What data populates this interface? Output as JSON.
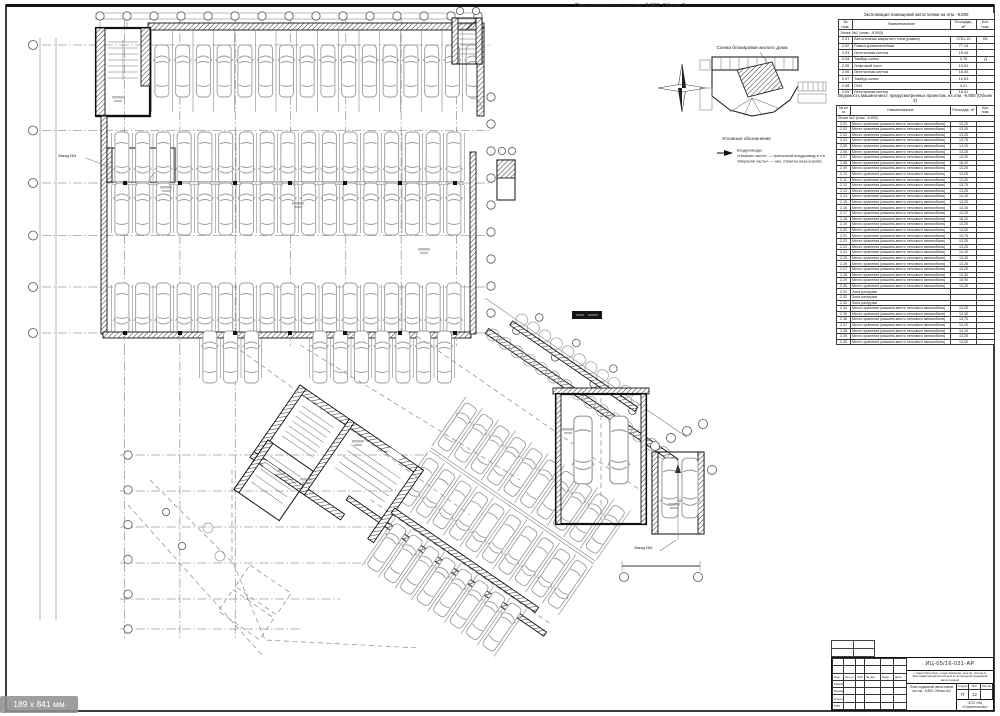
{
  "page": {
    "doc_title": "План автостоянки на отм. -9.800. Объем 2",
    "size_badge": "189 x 841 мм"
  },
  "key_plan": {
    "title": "Схема блокировки жилого дома"
  },
  "legend": {
    "title": "Условные обозначения",
    "heading": "Воздуховоды:",
    "line1": "«Нижняя часть» — приточный воздуховод в т/п",
    "line2": "«Верхняя часть» — низ. отметка низа короба"
  },
  "plan_labels": {
    "entry1": "Заезд №1",
    "entry2": "Заезд №2"
  },
  "tables": {
    "rooms": {
      "title": "Экспликация помещений автостоянки на отм. -9.800",
      "rows": [
        [
          "№ пом.",
          "Наименование",
          "Площадь, м²",
          "Кат. пом."
        ],
        [
          "@group",
          "Этаж №2 (отм. -9.800)"
        ],
        [
          "2.01",
          "Автостоянка закрытого типа (рампа)",
          "2761,10",
          "В1"
        ],
        [
          "2.02",
          "Рампа криволинейная",
          "77,14",
          ""
        ],
        [
          "2.03",
          "Лестничная клетка",
          "15,48",
          ""
        ],
        [
          "2.04",
          "Тамбур-шлюз",
          "4,76",
          "Д"
        ],
        [
          "2.05",
          "Лифтовой холл",
          "10,81",
          ""
        ],
        [
          "2.06",
          "Лестничная клетка",
          "16,45",
          ""
        ],
        [
          "2.07",
          "Тамбур-шлюз",
          "10,53",
          ""
        ],
        [
          "2.08",
          "ПУИ",
          "4,21",
          ""
        ],
        [
          "2.09",
          "Лестничная клетка",
          "16,31",
          ""
        ],
        [
          "2.10",
          "Тамбур-шлюз",
          "6,34",
          ""
        ],
        [
          "2.11",
          "Лифтовой холл",
          "8,09",
          ""
        ]
      ]
    },
    "parking": {
      "title": "Ведомость машино-мест, предусмотренных проектом, на отм. -9.800 (Объем 2)",
      "rows": [
        [
          "№ м/м",
          "Наименование",
          "Площадь, м²",
          "Кат. пом."
        ],
        [
          "@group",
          "Этаж №2 (отм. -9.800)"
        ],
        [
          "2.01",
          "Место хранения (машино-место легкового автомобиля)",
          "13,25",
          ""
        ],
        [
          "2.02",
          "Место хранения (машино-место легкового автомобиля)",
          "13,30",
          ""
        ],
        [
          "2.03",
          "Место хранения (машино-место легкового автомобиля)",
          "13,25",
          ""
        ],
        [
          "2.04",
          "Место хранения (машино-место легкового автомобиля)",
          "13,75",
          ""
        ],
        [
          "2.05",
          "Место хранения (машино-место легкового автомобиля)",
          "14,10",
          ""
        ],
        [
          "2.06",
          "Место хранения (машино-место легкового автомобиля)",
          "13,25",
          ""
        ],
        [
          "2.07",
          "Место хранения (машино-место легкового автомобиля)",
          "13,30",
          ""
        ],
        [
          "2.08",
          "Место хранения (машино-место легкового автомобиля)",
          "16,00",
          ""
        ],
        [
          "2.09",
          "Место хранения (машино-место легкового автомобиля)",
          "13,25",
          ""
        ],
        [
          "2.10",
          "Место хранения (машино-место легкового автомобиля)",
          "13,25",
          ""
        ],
        [
          "2.11",
          "Место хранения (машино-место легкового автомобиля)",
          "13,30",
          ""
        ],
        [
          "2.12",
          "Место хранения (машино-место легкового автомобиля)",
          "13,75",
          ""
        ],
        [
          "2.13",
          "Место хранения (машино-место легкового автомобиля)",
          "13,25",
          ""
        ],
        [
          "2.14",
          "Место хранения (машино-место легкового автомобиля)",
          "14,10",
          ""
        ],
        [
          "2.15",
          "Место хранения (машино-место легкового автомобиля)",
          "13,25",
          ""
        ],
        [
          "2.16",
          "Место хранения (машино-место легкового автомобиля)",
          "13,30",
          ""
        ],
        [
          "2.17",
          "Место хранения (машино-место легкового автомобиля)",
          "13,25",
          ""
        ],
        [
          "2.18",
          "Место хранения (машино-место легкового автомобиля)",
          "18,20",
          ""
        ],
        [
          "2.19",
          "Место хранения (машино-место легкового автомобиля)",
          "13,25",
          ""
        ],
        [
          "2.20",
          "Место хранения (машино-место легкового автомобиля)",
          "13,30",
          ""
        ],
        [
          "2.21",
          "Место хранения (машино-место легкового автомобиля)",
          "13,75",
          ""
        ],
        [
          "2.22",
          "Место хранения (машино-место легкового автомобиля)",
          "13,25",
          ""
        ],
        [
          "2.23",
          "Место хранения (машино-место легкового автомобиля)",
          "13,25",
          ""
        ],
        [
          "2.24",
          "Место хранения (машино-место легкового автомобиля)",
          "14,10",
          ""
        ],
        [
          "2.25",
          "Место хранения (машино-место легкового автомобиля)",
          "13,30",
          ""
        ],
        [
          "2.26",
          "Место хранения (машино-место легкового автомобиля)",
          "13,25",
          ""
        ],
        [
          "2.27",
          "Место хранения (машино-место легкового автомобиля)",
          "13,25",
          ""
        ],
        [
          "2.28",
          "Место хранения (машино-место легкового автомобиля)",
          "13,30",
          ""
        ],
        [
          "2.29",
          "Место хранения (машино-место легкового автомобиля)",
          "15,90",
          ""
        ],
        [
          "2.30",
          "Место хранения (машино-место легкового автомобиля)",
          "13,25",
          ""
        ],
        [
          "2.31",
          "Зона разгрузки",
          "",
          ""
        ],
        [
          "2.32",
          "Зона разгрузки",
          "",
          ""
        ],
        [
          "2.33",
          "Зона разгрузки",
          "",
          ""
        ],
        [
          "2.34",
          "Место хранения (машино-место легкового автомобиля)",
          "13,25",
          ""
        ],
        [
          "2.35",
          "Место хранения (машино-место легкового автомобиля)",
          "13,30",
          ""
        ],
        [
          "2.36",
          "Место хранения (машино-место легкового автомобиля)",
          "13,75",
          ""
        ],
        [
          "2.37",
          "Место хранения (машино-место легкового автомобиля)",
          "13,25",
          ""
        ],
        [
          "2.38",
          "Место хранения (машино-место легкового автомобиля)",
          "14,10",
          ""
        ],
        [
          "2.39",
          "Место хранения (машино-место легкового автомобиля)",
          "13,25",
          ""
        ],
        [
          "2.40",
          "Место хранения (машино-место легкового автомобиля)",
          "13,30",
          ""
        ]
      ]
    }
  },
  "stamp": {
    "code": "ИЦ-05/16-031-АР",
    "object_line": "г. Санкт-Петербург, улица Типанова, дом 21, литера А. Многоквартирный жилой дом со встроенной подземной автостоянкой",
    "sheet_title": "План подземной автостоянки на отм. -9.800. Объем №2",
    "stage_label": "Стадия",
    "sheet_label": "Лист",
    "sheets_label": "Листов",
    "stage": "П",
    "sheet_no": "12",
    "sheets_total": "",
    "org": "ООО «НЦ «Строительство»",
    "left_rows": [
      [
        "",
        "",
        "",
        "",
        "",
        ""
      ],
      [
        "",
        "",
        "",
        "",
        "",
        ""
      ],
      [
        "Изм.",
        "Кол.уч.",
        "Лист",
        "№ док.",
        "Подп.",
        "Дата"
      ],
      [
        "Разраб.",
        "",
        "",
        "",
        "",
        ""
      ],
      [
        "Проверил",
        "",
        "",
        "",
        "",
        ""
      ],
      [
        "Н.контр.",
        "",
        "",
        "",
        "",
        ""
      ],
      [
        "ГИП",
        "",
        "",
        "",
        "",
        ""
      ]
    ],
    "approval_rows": [
      [
        "",
        ""
      ],
      [
        "",
        ""
      ],
      [
        "",
        ""
      ]
    ]
  }
}
